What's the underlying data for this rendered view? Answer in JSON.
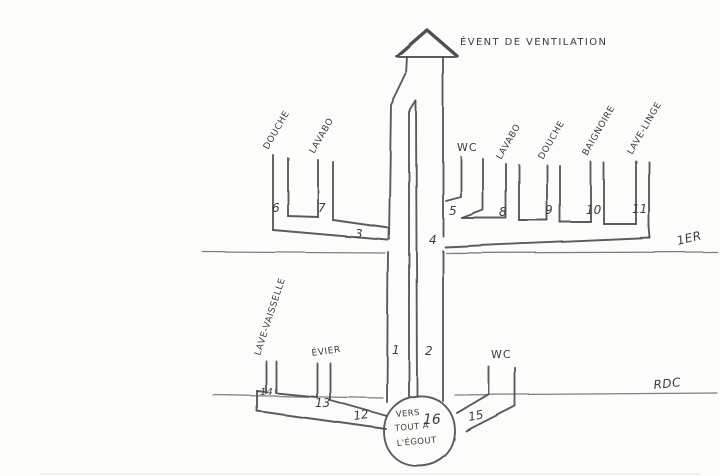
{
  "vent": {
    "label": "ÉVENT DE VENTILATION"
  },
  "floors": {
    "first_label": "1ER",
    "ground_label": "RDC"
  },
  "fixtures": {
    "first_floor": [
      {
        "label": "DOUCHE",
        "number": "6"
      },
      {
        "label": "LAVABO",
        "number": "7"
      },
      {
        "label": "WC",
        "number": "5"
      },
      {
        "label": "LAVABO",
        "number": "8"
      },
      {
        "label": "DOUCHE",
        "number": "9"
      },
      {
        "label": "BAIGNOIRE",
        "number": "10"
      },
      {
        "label": "LAVE-LINGE",
        "number": "11"
      }
    ],
    "ground_floor": [
      {
        "label": "LAVE-VAISSELLE",
        "number": "14"
      },
      {
        "label": "ÉVIER",
        "number": "13"
      },
      {
        "label": "WC",
        "number": "15"
      }
    ]
  },
  "pipes": {
    "stack_left_number": "1",
    "stack_right_number": "2",
    "left_collector_number": "3",
    "right_collector_number": "4",
    "ground_collector_number": "12"
  },
  "sewer": {
    "number": "16",
    "line1": "VERS",
    "line2": "TOUT A",
    "line3": "L'ÉGOUT"
  },
  "colors": {
    "ink": "#4f4f4f",
    "paper": "#fcfcfa"
  }
}
